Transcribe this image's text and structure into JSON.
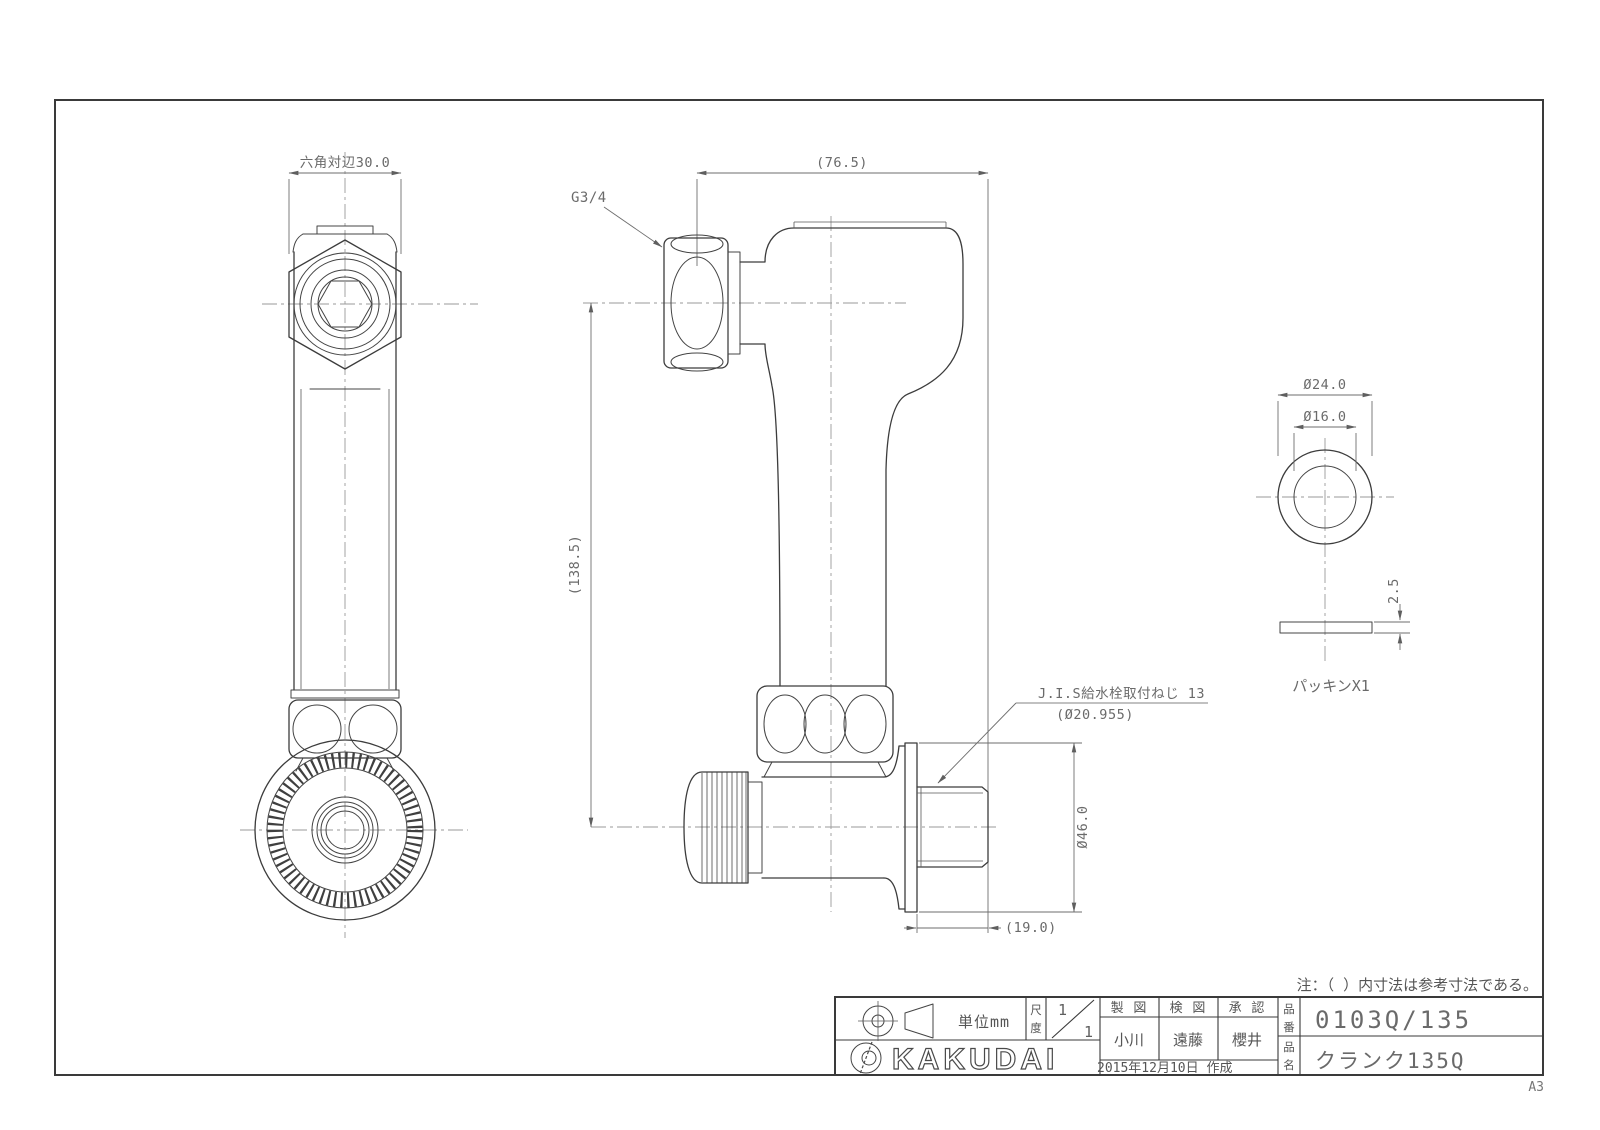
{
  "sheet": {
    "size_label": "A3"
  },
  "note": "注：（ ）内寸法は参考寸法である。",
  "front_view": {
    "dim_across_flats": "六角対辺30.0"
  },
  "side_view": {
    "dim_width": "(76.5)",
    "top_thread": "G3/4",
    "dim_height": "(138.5)",
    "wall_thread_line1": "J.I.S給水栓取付ねじ 13",
    "wall_thread_line2": "(Ø20.955)",
    "dim_flange_dia": "Ø46.0",
    "dim_thread_len": "(19.0)"
  },
  "packing_view": {
    "dim_outer_dia": "Ø24.0",
    "dim_inner_dia": "Ø16.0",
    "dim_thickness": "2.5",
    "label": "パッキンX1"
  },
  "title_block": {
    "unit": "単位mm",
    "scale_label_1": "尺",
    "scale_label_2": "度",
    "scale_num": "1",
    "scale_den": "1",
    "brand": "KAKUDAI",
    "col_draft": "製 図",
    "col_check": "検 図",
    "col_approve": "承 認",
    "name_draft": "小川",
    "name_check": "遠藤",
    "name_approve": "櫻井",
    "date": "2015年12月10日 作成",
    "part_no_label_1": "品",
    "part_no_label_2": "番",
    "part_name_label_1": "品",
    "part_name_label_2": "名",
    "part_no": "0103Q/135",
    "part_name": "クランク135Q"
  }
}
